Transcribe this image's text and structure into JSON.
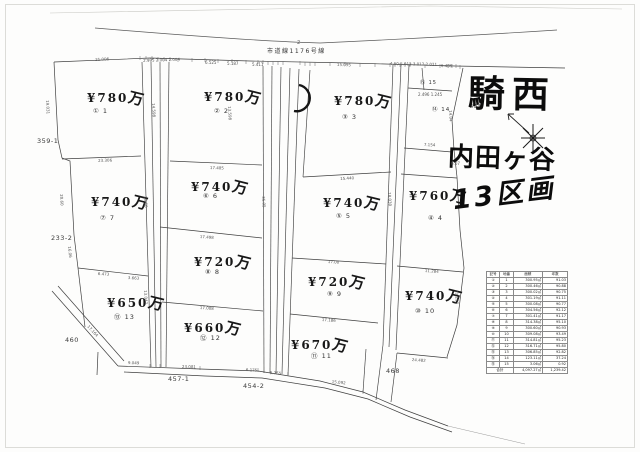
{
  "road": {
    "label": "市道線1176号線"
  },
  "handwriting": {
    "area": "騎西",
    "district": "内田ヶ谷",
    "count": "13区画",
    "note": "403"
  },
  "parcels": {
    "p359": "359-1",
    "p233": "233-2",
    "p460": "460",
    "p457": "457-1",
    "p454": "454-2",
    "p468": "468"
  },
  "plots": [
    {
      "label": "① 1",
      "yen": "¥780",
      "man": "万"
    },
    {
      "label": "② 2",
      "yen": "¥780",
      "man": "万"
    },
    {
      "label": "③ 3",
      "yen": "¥780",
      "man": "万"
    },
    {
      "label": "④ 4",
      "yen": "¥760",
      "man": "万"
    },
    {
      "label": "⑤ 5",
      "yen": "¥740",
      "man": "万"
    },
    {
      "label": "⑥ 6",
      "yen": "¥740",
      "man": "万"
    },
    {
      "label": "⑦ 7",
      "yen": "¥740",
      "man": "万"
    },
    {
      "label": "⑧ 8",
      "yen": "¥720",
      "man": "万"
    },
    {
      "label": "⑨ 9",
      "yen": "¥720",
      "man": "万"
    },
    {
      "label": "⑩ 10",
      "yen": "¥740",
      "man": "万"
    },
    {
      "label": "⑪ 11",
      "yen": "¥670",
      "man": "万"
    },
    {
      "label": "⑫ 12",
      "yen": "¥660",
      "man": "万"
    },
    {
      "label": "⑬ 13",
      "yen": "¥650",
      "man": "万"
    },
    {
      "label": "⑭ 14",
      "yen": "",
      "man": ""
    },
    {
      "label": "⑮ 15",
      "yen": "",
      "man": ""
    }
  ],
  "dims": [
    "21.006",
    "2.995 2.004 2.004",
    "6.525",
    "5.187",
    "5.411",
    "15.095",
    "4.50 5.012 3.012 2.021",
    "6.485",
    "19.031",
    "20.60",
    "16.06",
    "23.306",
    "17.485",
    "15.440",
    "17.498",
    "6.473",
    "3.663",
    "17.008",
    "17.00",
    "17.186",
    "11.284",
    "24.482",
    "9.049",
    "23.081",
    "6.175",
    "5.755",
    "15.092",
    "13.293",
    "14.04",
    "30.60",
    "35.05",
    "17.164",
    "13.047",
    "2",
    "18.030",
    "13.598",
    "14.598",
    "7.154",
    "2.496 1.245",
    "6.07"
  ],
  "table": {
    "headers": [
      "記号",
      "地番",
      "面積",
      "坪数"
    ],
    "rows": [
      {
        "sym": "①",
        "no": "1",
        "area": "300.95㎡",
        "tsubo": "91.03"
      },
      {
        "sym": "②",
        "no": "2",
        "area": "300.46㎡",
        "tsubo": "90.88"
      },
      {
        "sym": "③",
        "no": "3",
        "area": "300.02㎡",
        "tsubo": "90.75"
      },
      {
        "sym": "④",
        "no": "4",
        "area": "301.19㎡",
        "tsubo": "91.11"
      },
      {
        "sym": "⑤",
        "no": "5",
        "area": "300.08㎡",
        "tsubo": "90.77"
      },
      {
        "sym": "⑥",
        "no": "6",
        "area": "304.56㎡",
        "tsubo": "92.12"
      },
      {
        "sym": "⑦",
        "no": "7",
        "area": "301.41㎡",
        "tsubo": "91.17"
      },
      {
        "sym": "⑧",
        "no": "8",
        "area": "314.38㎡",
        "tsubo": "95.10"
      },
      {
        "sym": "⑨",
        "no": "9",
        "area": "300.60㎡",
        "tsubo": "90.93"
      },
      {
        "sym": "⑩",
        "no": "10",
        "area": "309.08㎡",
        "tsubo": "93.49"
      },
      {
        "sym": "⑪",
        "no": "11",
        "area": "314.81㎡",
        "tsubo": "95.23"
      },
      {
        "sym": "⑫",
        "no": "12",
        "area": "316.71㎡",
        "tsubo": "95.80"
      },
      {
        "sym": "⑬",
        "no": "13",
        "area": "306.85㎡",
        "tsubo": "92.82"
      },
      {
        "sym": "⑭",
        "no": "14",
        "area": "123.11㎡",
        "tsubo": "37.24"
      },
      {
        "sym": "⑮",
        "no": "15",
        "area": "3.06㎡",
        "tsubo": "0.92"
      }
    ],
    "total": {
      "label": "合計",
      "area": "4,097.27㎡",
      "tsubo": "1,239.42"
    }
  }
}
